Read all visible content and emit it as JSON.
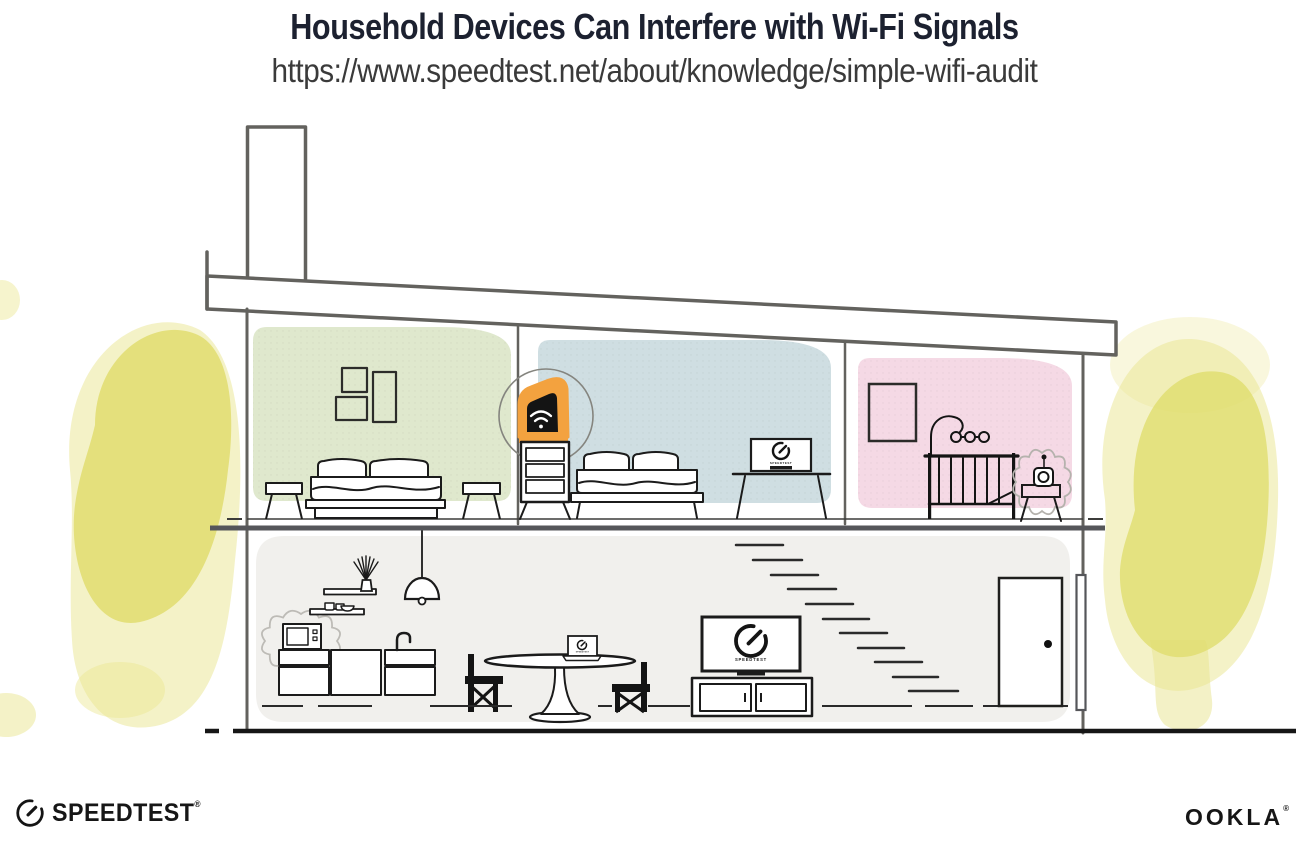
{
  "header": {
    "title": "Household Devices Can Interfere with Wi-Fi Signals",
    "url": "https://www.speedtest.net/about/knowledge/simple-wifi-audit"
  },
  "screens": {
    "tv_brand": "SPEEDTEST",
    "monitor_brand": "SPEEDTEST",
    "laptop_brand": "SPEEDTEST"
  },
  "footer": {
    "speedtest_wordmark": "SPEEDTEST",
    "speedtest_reg": "®",
    "ookla_wordmark": "OOKLA",
    "ookla_reg": "®"
  },
  "icons": {
    "router": "wifi-icon",
    "tv_screen": "speedtest-gauge-icon",
    "monitor_screen": "speedtest-gauge-icon",
    "laptop_screen": "speedtest-gauge-icon",
    "footer_logo": "speedtest-gauge-icon",
    "microwave_highlight": "interference-cloud",
    "baby_monitor_highlight": "interference-cloud",
    "router_highlight": "orange-highlight-circle"
  },
  "colors": {
    "title_navy": "#1c2130",
    "accent_orange": "#f3a23f",
    "room_green": "#dfe8cd",
    "room_blue": "#cfdee2",
    "room_pink": "#f5d9e5",
    "floor_gray": "#f1f0ed",
    "foliage_yellow": "#e0dd6e",
    "structure_gray": "#63625e",
    "line_dark": "#1b1b1b"
  }
}
